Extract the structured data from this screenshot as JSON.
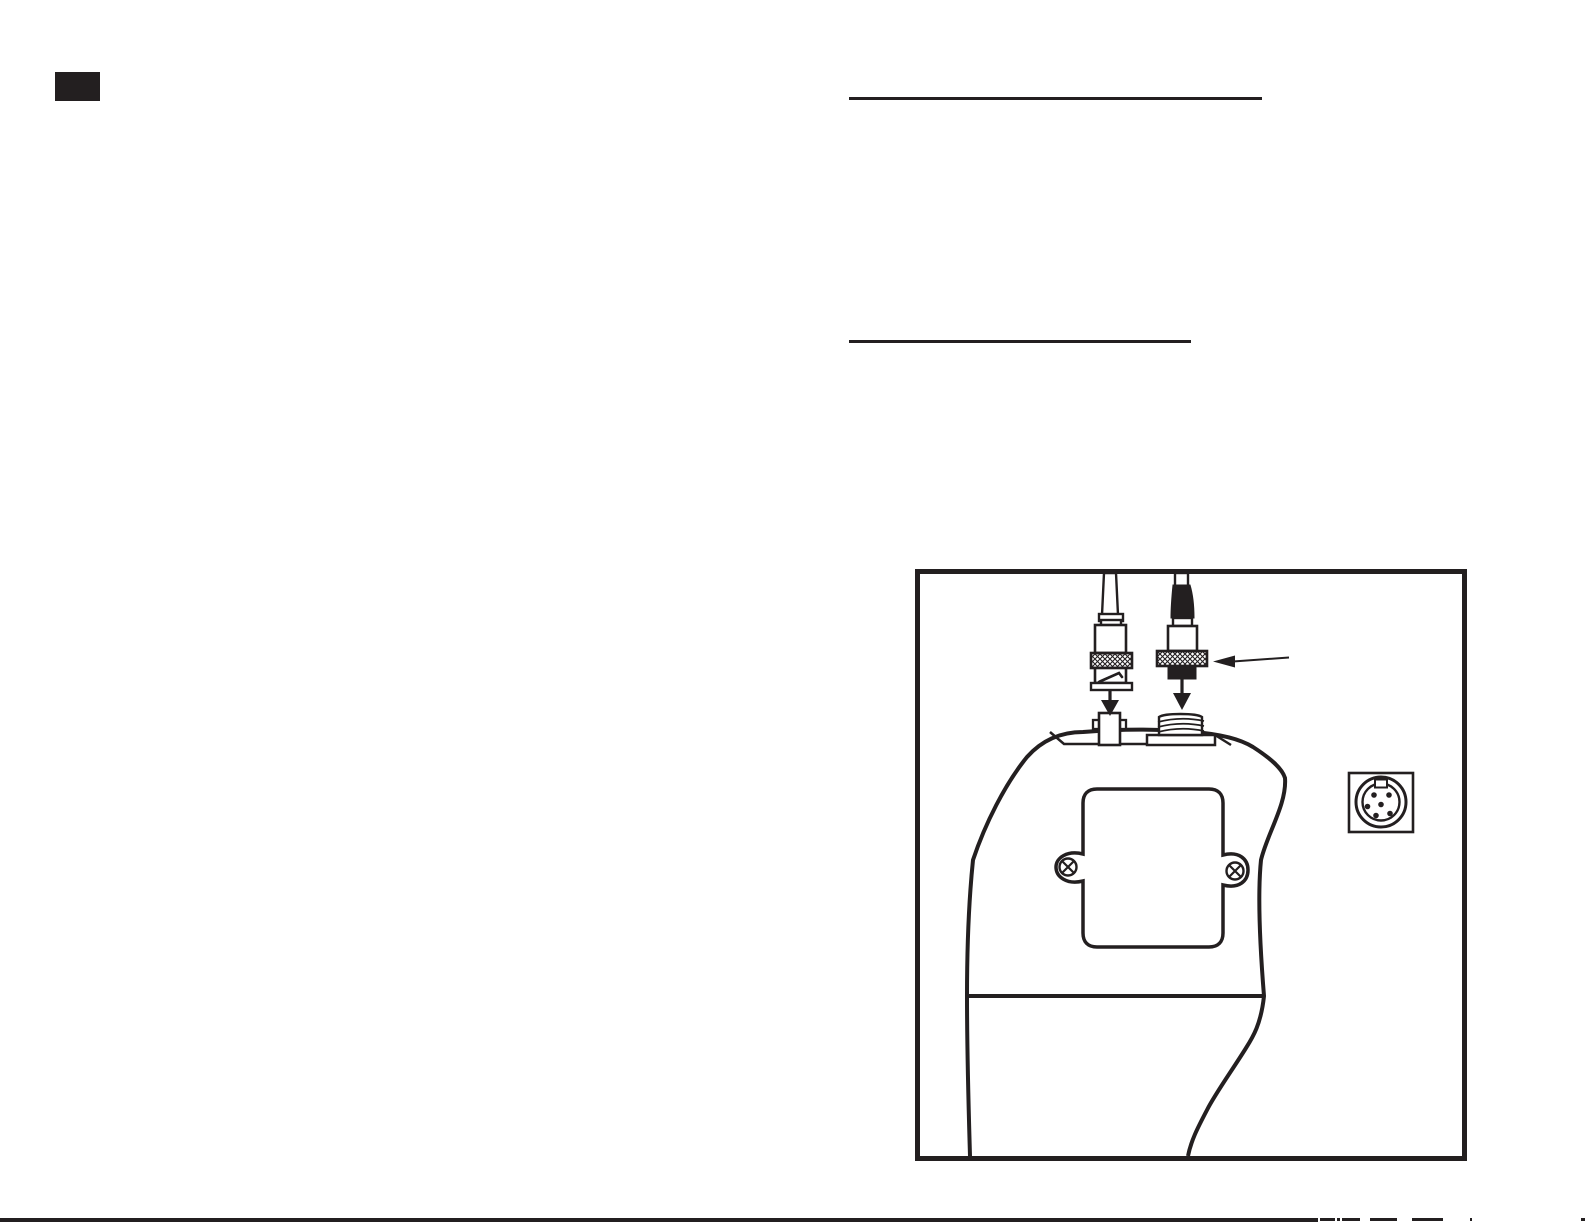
{
  "page": {
    "kind": "instruction-manual page (body text not visible; only printed marks and line-art figure)",
    "visible_text": "",
    "colors": {
      "paper": "#ffffff",
      "ink": "#231f20"
    }
  },
  "marks": {
    "page_number_block": {
      "shape": "solid black rectangle",
      "text": ""
    },
    "heading_rule_1": {
      "shape": "horizontal rule under an (invisible) heading",
      "text": ""
    },
    "heading_rule_2": {
      "shape": "horizontal rule under an (invisible) heading",
      "text": ""
    },
    "bottom_edge": {
      "shape": "black page-edge line with small cropped fragments at right",
      "text": ""
    }
  },
  "figure": {
    "description": "Line drawing of a handheld meter (top view) with two cable connectors being attached",
    "parts": [
      "bnc-cable-connector",
      "bnc-knurled-ring",
      "bnc-jack-on-meter",
      "probe-cable-connector",
      "probe-knurled-ring",
      "threaded-socket-on-meter",
      "down-arrow-left",
      "down-arrow-right",
      "callout-arrow-to-knurled-ring",
      "meter-body",
      "battery-cover-panel",
      "panel-screw-left",
      "panel-screw-right",
      "din-socket-port"
    ]
  },
  "bottom_fragments": [
    {
      "x": 1320,
      "w": 15
    },
    {
      "x": 1337,
      "w": 3
    },
    {
      "x": 1342,
      "w": 18
    },
    {
      "x": 1370,
      "w": 27
    },
    {
      "x": 1412,
      "w": 31
    },
    {
      "x": 1470,
      "w": 2
    },
    {
      "x": 1581,
      "w": 4
    }
  ]
}
